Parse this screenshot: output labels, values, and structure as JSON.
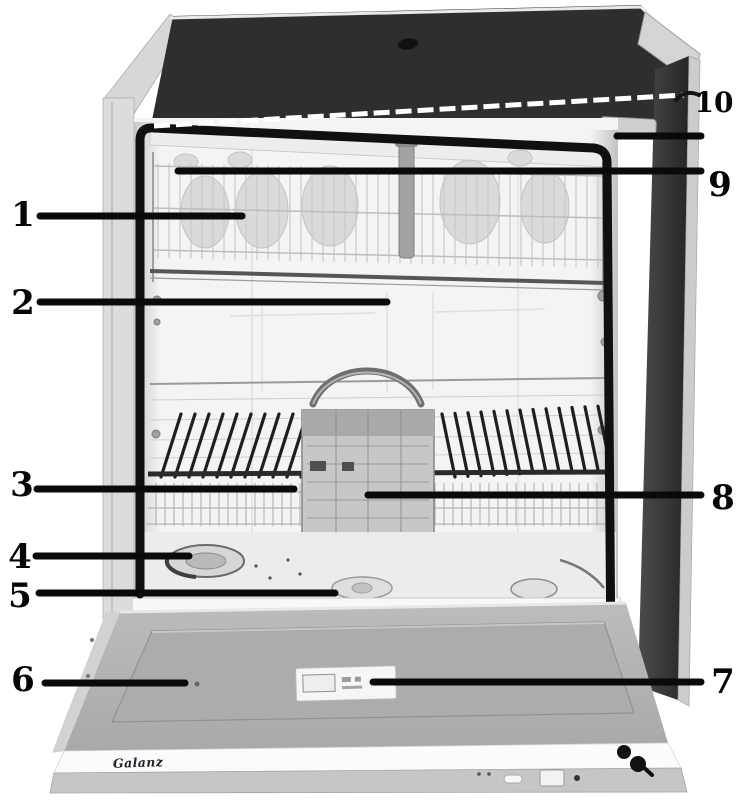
{
  "figure": {
    "callouts": [
      {
        "number": "1"
      },
      {
        "number": "2"
      },
      {
        "number": "3"
      },
      {
        "number": "4"
      },
      {
        "number": "5"
      },
      {
        "number": "6"
      },
      {
        "number": "7"
      },
      {
        "number": "8"
      },
      {
        "number": "9"
      },
      {
        "number": "10"
      }
    ],
    "brand_text": "Galanz",
    "colors": {
      "background": "#ffffff",
      "ink": "#0a0a0a",
      "worktop": "#2e2e2e",
      "side_panel": "#3a3a3a",
      "door": "#b5b5b5",
      "white_leader": "#ffffff"
    }
  }
}
